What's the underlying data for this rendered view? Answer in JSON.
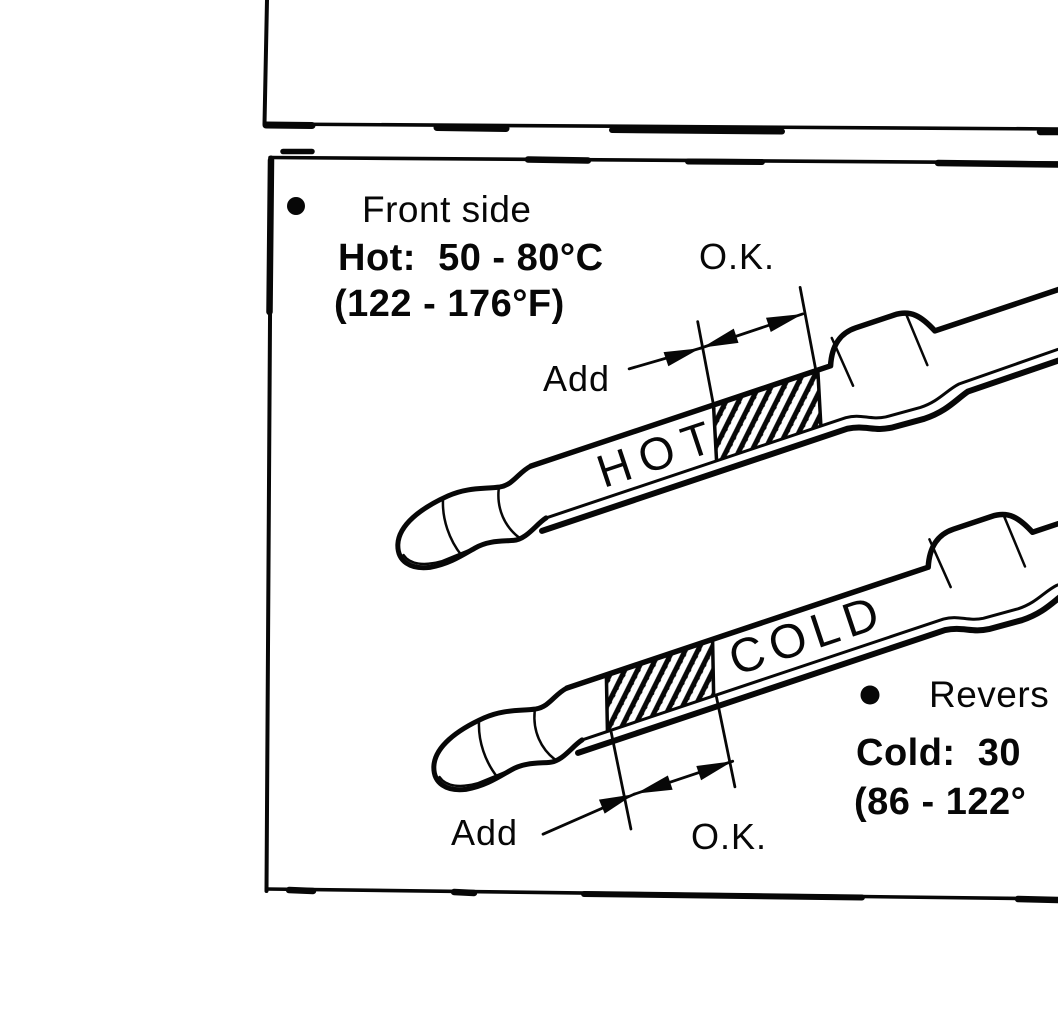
{
  "colors": {
    "ink": "#070707",
    "paper": "#ffffff"
  },
  "figure": {
    "front_side": {
      "bullet_icon": "●",
      "label": "Front side",
      "temp_line_c": "Hot:  50 - 80°C",
      "temp_line_f": "(122 - 176°F)",
      "ok_label": "O.K.",
      "add_label": "Add",
      "stick_text": "HOT"
    },
    "reverse_side": {
      "bullet_icon": "●",
      "label": "Revers",
      "temp_line_c": "Cold:  30",
      "temp_line_f": "(86 - 122°",
      "ok_label": "O.K.",
      "add_label": "Add",
      "stick_text": "COLD"
    }
  }
}
